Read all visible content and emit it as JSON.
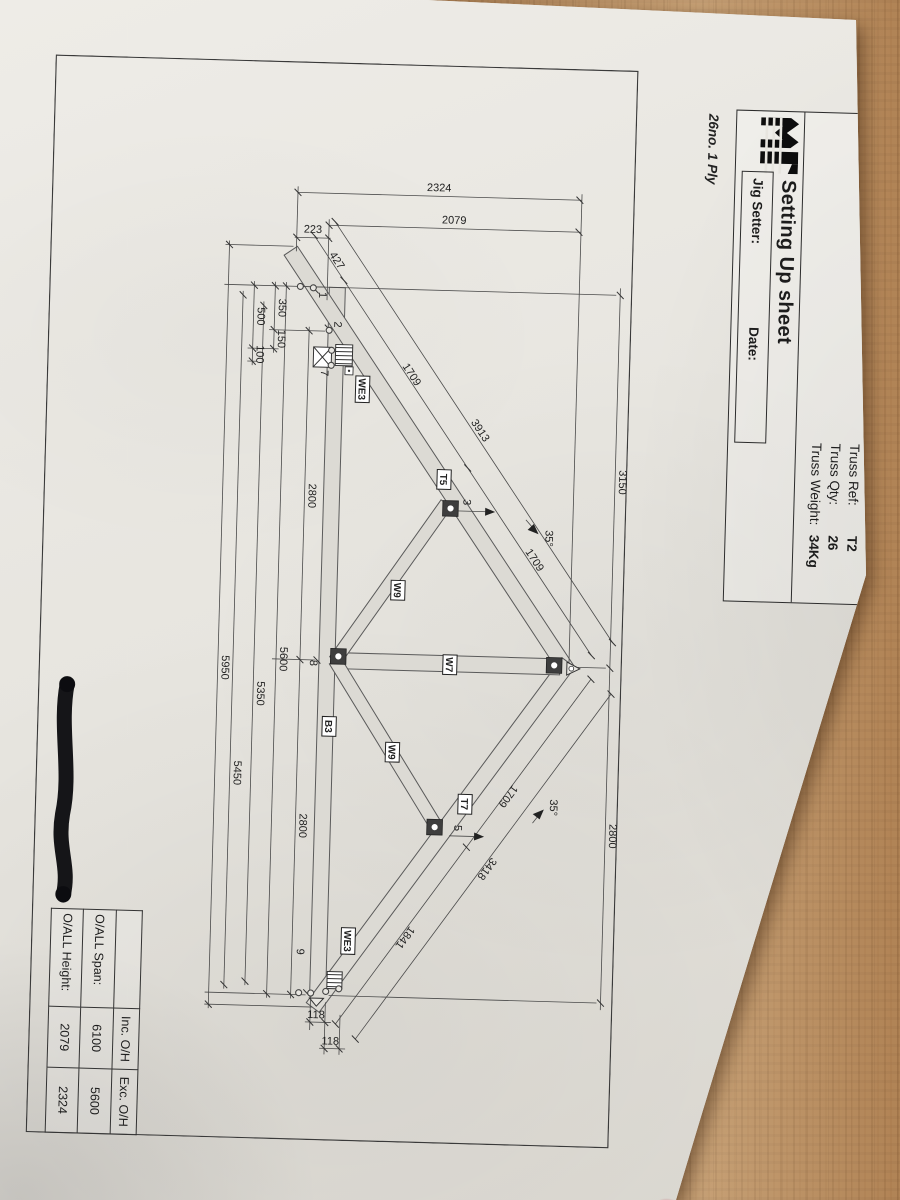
{
  "sheet": {
    "logo_name": "mitek-logo",
    "title": "Setting Up sheet",
    "truss_ref_label": "Truss Ref:",
    "truss_ref": "T2",
    "truss_qty_label": "Truss Qty:",
    "truss_qty": "26",
    "truss_weight_label": "Truss Weight:",
    "truss_weight": "34Kg",
    "jig_setter_label": "Jig Setter:",
    "date_label": "Date:",
    "ply_note": "26no. 1 Ply"
  },
  "summary_table": {
    "col_headers": [
      "Inc. O/H",
      "Exc. O/H"
    ],
    "rows": [
      {
        "label": "O/ALL Span:",
        "inc": "6100",
        "exc": "5600"
      },
      {
        "label": "O/ALL Height:",
        "inc": "2079",
        "exc": "2324"
      }
    ]
  },
  "diagram": {
    "pitch_angle": "35°",
    "dim_labels": [
      {
        "text": "3150",
        "x": 412,
        "y": 8,
        "rot": 0
      },
      {
        "text": "2800",
        "x": 766,
        "y": 8,
        "rot": 0
      },
      {
        "text": "2324",
        "x": 126,
        "y": 196,
        "rot": -90
      },
      {
        "text": "2079",
        "x": 158,
        "y": 180,
        "rot": -90
      },
      {
        "text": "223",
        "x": 171,
        "y": 321,
        "rot": -90
      },
      {
        "text": "2800",
        "x": 434,
        "y": 318,
        "rot": 0
      },
      {
        "text": "2800",
        "x": 764,
        "y": 318,
        "rot": 0
      },
      {
        "text": "5600",
        "x": 598,
        "y": 342,
        "rot": 0
      },
      {
        "text": "5350",
        "x": 633,
        "y": 364,
        "rot": 0
      },
      {
        "text": "5450",
        "x": 713,
        "y": 385,
        "rot": 0
      },
      {
        "text": "5950",
        "x": 608,
        "y": 400,
        "rot": 0
      },
      {
        "text": "350",
        "x": 247,
        "y": 353,
        "rot": 0
      },
      {
        "text": "150",
        "x": 278,
        "y": 353,
        "rot": 0
      },
      {
        "text": "500",
        "x": 256,
        "y": 374,
        "rot": 0
      },
      {
        "text": "100",
        "x": 294,
        "y": 374,
        "rot": 0
      },
      {
        "text": "118",
        "x": 956,
        "y": 296,
        "rot": -90
      },
      {
        "text": "118",
        "x": 982,
        "y": 281,
        "rot": -90
      },
      {
        "text": "427",
        "x": 200,
        "y": 299,
        "rot": -35
      },
      {
        "text": "1709",
        "x": 312,
        "y": 221,
        "rot": -35
      },
      {
        "text": "1709",
        "x": 494,
        "y": 93,
        "rot": -35
      },
      {
        "text": "3913",
        "x": 366,
        "y": 151,
        "rot": -35
      },
      {
        "text": "1709",
        "x": 727,
        "y": 113,
        "rot": 35
      },
      {
        "text": "1841",
        "x": 871,
        "y": 212,
        "rot": 35
      },
      {
        "text": "3418",
        "x": 800,
        "y": 132,
        "rot": 35
      }
    ],
    "angle_labels": [
      {
        "text": "35°",
        "x": 470,
        "y": 80
      },
      {
        "text": "35°",
        "x": 739,
        "y": 68
      }
    ],
    "member_labels": [
      {
        "text": "WE3",
        "x": 326,
        "y": 271
      },
      {
        "text": "T5",
        "x": 414,
        "y": 187
      },
      {
        "text": "W9",
        "x": 526,
        "y": 230
      },
      {
        "text": "W7",
        "x": 599,
        "y": 176
      },
      {
        "text": "B3",
        "x": 664,
        "y": 295
      },
      {
        "text": "W9",
        "x": 688,
        "y": 231
      },
      {
        "text": "T7",
        "x": 738,
        "y": 157
      },
      {
        "text": "WE3",
        "x": 878,
        "y": 270
      }
    ],
    "node_labels": [
      {
        "text": "1",
        "x": 233,
        "y": 313
      },
      {
        "text": "2",
        "x": 262,
        "y": 297
      },
      {
        "text": "7",
        "x": 311,
        "y": 309
      },
      {
        "text": "3",
        "x": 436,
        "y": 163
      },
      {
        "text": "5",
        "x": 762,
        "y": 163
      },
      {
        "text": "8",
        "x": 601,
        "y": 312
      },
      {
        "text": "9",
        "x": 890,
        "y": 317
      }
    ]
  }
}
